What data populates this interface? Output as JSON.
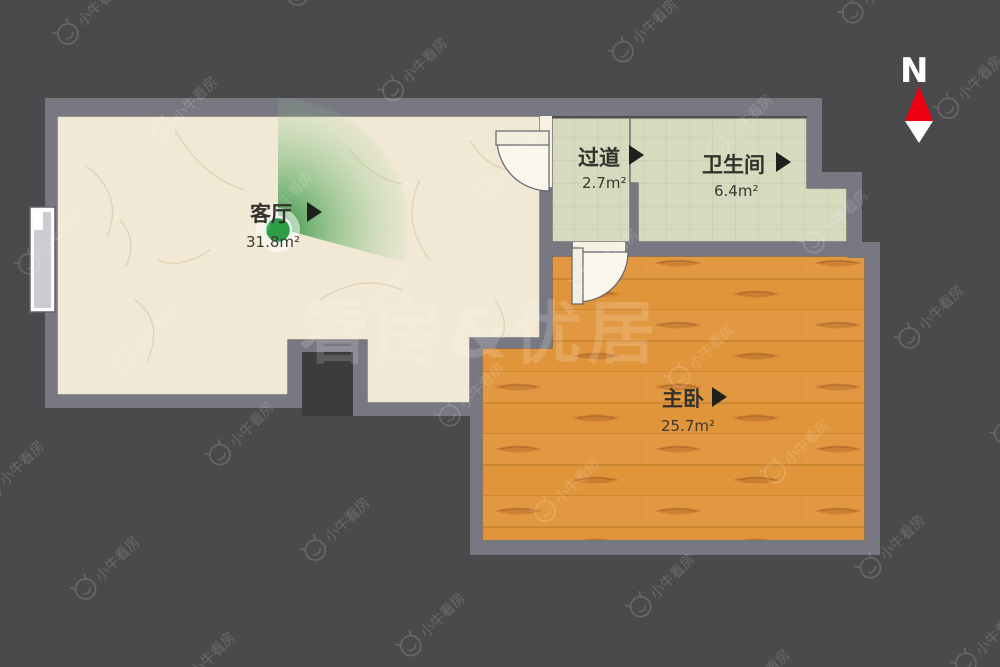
{
  "canvas": {
    "background": "#4a4a4c",
    "wall_color": "#787882"
  },
  "compass": {
    "label": "N",
    "north_color": "#ee0010",
    "south_color": "#ffffff"
  },
  "watermarks": {
    "brand": "小牛看房",
    "center": "看房&优居"
  },
  "rooms": [
    {
      "id": "living-room",
      "name": "客厅",
      "area": "31.8m²",
      "floor_type": "marble",
      "floor_color": "#f1e9d5"
    },
    {
      "id": "corridor",
      "name": "过道",
      "area": "2.7m²",
      "floor_type": "tile",
      "floor_color": "#d8dac0"
    },
    {
      "id": "bathroom",
      "name": "卫生间",
      "area": "6.4m²",
      "floor_type": "tile",
      "floor_color": "#d8dac0"
    },
    {
      "id": "master-bedroom",
      "name": "主卧",
      "area": "25.7m²",
      "floor_type": "wood",
      "floor_color": "#e0953b"
    }
  ],
  "camera": {
    "room": "living-room",
    "dot_color": "#2e9e46"
  }
}
